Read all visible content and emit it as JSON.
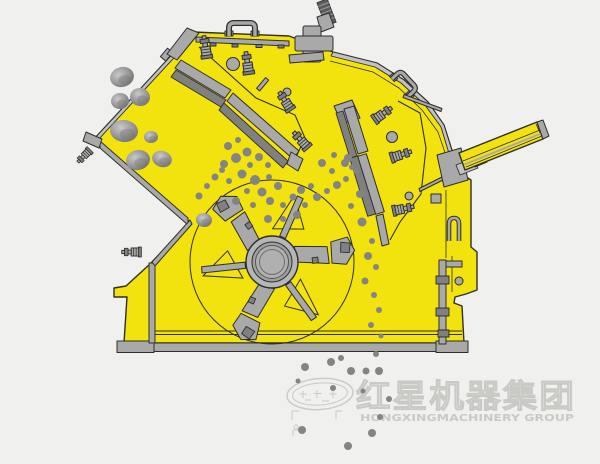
{
  "scene": {
    "type": "machinery cross-section diagram",
    "subject": "impact crusher side cutaway with feed chute, rotor with blow bars, two spring-bolted impact aprons, adjustment cylinder, falling rocks and crushed material",
    "machine_color_note": "yellow housing with gray steel parts on light gray background"
  },
  "colors": {
    "bg": "#f0f0ee",
    "body": "#f2e20d",
    "outline": "#2e2e2e",
    "metal": "#a9a9a9",
    "metal-light": "#c2c2c2",
    "metal-dark": "#808080",
    "metal-darker": "#5c5c5c",
    "particle": "#848484",
    "watermark": "#c9c9c5"
  },
  "watermark": {
    "company_cn": "红星机器集团",
    "company_en": "HONGXINGMACHINERY GROUP",
    "logo": "oval-star-logo"
  },
  "particles": {
    "feed_rocks": [
      [
        122,
        77,
        12,
        10,
        -15
      ],
      [
        140,
        97,
        10,
        9,
        12
      ],
      [
        120,
        101,
        9,
        8,
        -5
      ],
      [
        124,
        131,
        14,
        11,
        6
      ],
      [
        138,
        160,
        12,
        10,
        -12
      ],
      [
        162,
        159,
        10,
        8,
        18
      ],
      [
        151,
        137,
        7,
        6,
        0
      ],
      [
        204,
        220,
        8,
        7,
        8
      ]
    ],
    "chamber": [
      [
        199,
        196,
        3.5
      ],
      [
        207,
        186,
        3
      ],
      [
        215,
        177,
        3.5
      ],
      [
        222,
        170,
        3
      ],
      [
        228,
        146,
        4
      ],
      [
        238,
        140,
        3
      ],
      [
        247,
        152,
        4.5
      ],
      [
        236,
        158,
        5
      ],
      [
        224,
        164,
        4
      ],
      [
        250,
        165,
        3
      ],
      [
        259,
        157,
        4
      ],
      [
        268,
        165,
        3
      ],
      [
        242,
        174,
        4.5
      ],
      [
        229,
        181,
        3
      ],
      [
        255,
        180,
        5
      ],
      [
        269,
        177,
        3
      ],
      [
        278,
        186,
        4
      ],
      [
        262,
        192,
        4.5
      ],
      [
        247,
        191,
        3
      ],
      [
        236,
        201,
        4
      ],
      [
        253,
        205,
        3
      ],
      [
        270,
        201,
        4
      ],
      [
        283,
        205,
        3
      ],
      [
        293,
        197,
        3.5
      ],
      [
        301,
        190,
        4
      ],
      [
        311,
        186,
        3
      ],
      [
        297,
        215,
        4
      ],
      [
        283,
        219,
        3
      ],
      [
        268,
        219,
        4
      ],
      [
        305,
        205,
        3
      ],
      [
        317,
        197,
        4
      ],
      [
        327,
        191,
        3
      ],
      [
        337,
        185,
        4
      ],
      [
        346,
        179,
        3
      ],
      [
        332,
        171,
        3
      ],
      [
        322,
        163,
        4
      ],
      [
        334,
        155,
        3
      ],
      [
        345,
        163,
        4
      ],
      [
        356,
        171,
        3
      ],
      [
        348,
        158,
        4
      ],
      [
        352,
        167,
        3
      ],
      [
        360,
        194,
        4
      ],
      [
        351,
        206,
        3
      ],
      [
        362,
        222,
        4.5
      ],
      [
        372,
        241,
        3
      ],
      [
        368,
        256,
        4
      ],
      [
        376,
        267,
        3
      ],
      [
        365,
        281,
        3.5
      ],
      [
        374,
        295,
        3
      ],
      [
        379,
        310,
        3
      ],
      [
        371,
        325,
        3
      ],
      [
        381,
        336,
        2.5
      ]
    ],
    "discharge": [
      [
        305,
        367,
        4
      ],
      [
        331,
        362,
        4
      ],
      [
        341,
        358,
        3
      ],
      [
        351,
        371,
        4
      ],
      [
        366,
        371,
        3.5
      ],
      [
        376,
        354,
        3
      ],
      [
        379,
        371,
        4
      ],
      [
        333,
        388,
        3
      ],
      [
        363,
        391,
        2.5
      ],
      [
        389,
        399,
        3
      ],
      [
        380,
        417,
        3
      ],
      [
        302,
        430,
        4
      ],
      [
        372,
        433,
        4
      ],
      [
        348,
        446,
        4
      ],
      [
        298,
        381,
        2.5
      ]
    ]
  }
}
